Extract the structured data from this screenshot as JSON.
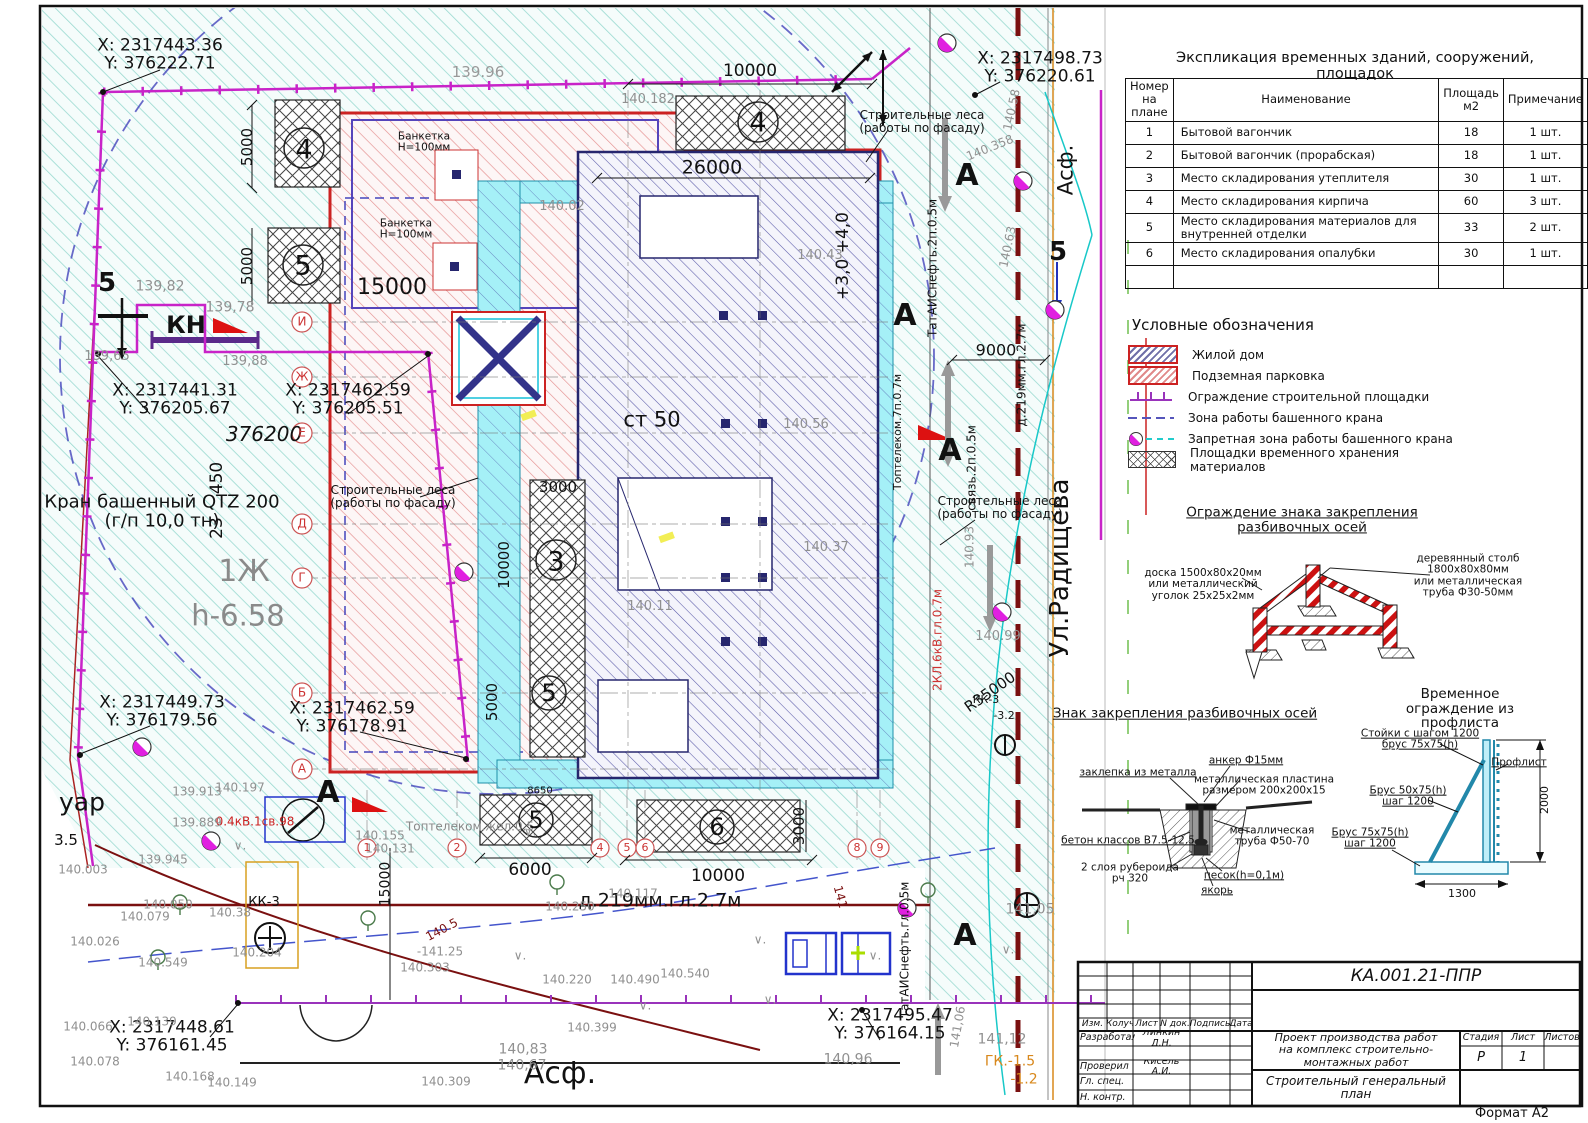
{
  "sheet": {
    "format_label": "Формат А2",
    "doc_code": "КА.001.21-ППР"
  },
  "expl_table": {
    "title": "Экспликация временных зданий, сооружений, площадок",
    "headers": [
      "Номер на плане",
      "Наименование",
      "Площадь м2",
      "Примечание"
    ],
    "rows": [
      [
        "1",
        "Бытовой вагончик",
        "18",
        "1 шт."
      ],
      [
        "2",
        "Бытовой вагончик (прорабская)",
        "18",
        "1 шт."
      ],
      [
        "3",
        "Место складирования утеплителя",
        "30",
        "1 шт."
      ],
      [
        "4",
        "Место складирования кирпича",
        "60",
        "3 шт."
      ],
      [
        "5",
        "Место складирования материалов для внутренней отделки",
        "33",
        "2 шт."
      ],
      [
        "6",
        "Место складирования опалубки",
        "30",
        "1 шт."
      ],
      [
        "",
        "",
        "",
        ""
      ]
    ]
  },
  "legend": {
    "title": "Условные обозначения",
    "items": [
      {
        "swatch": "dom",
        "label": "Жилой дом"
      },
      {
        "swatch": "park",
        "label": "Подземная парковка"
      },
      {
        "swatch": "fence",
        "label": "Ограждение строительной площадки"
      },
      {
        "swatch": "crane",
        "label": "Зона работы башенного крана"
      },
      {
        "swatch": "nozone",
        "label": "Запретная зона работы башенного крана"
      },
      {
        "swatch": "store",
        "label": "Площадки временного хранения материалов"
      }
    ]
  },
  "colors": {
    "fence": "#c823c8",
    "parking": "#cc2222",
    "building": "#26266e",
    "scaffold": "#1e8fa8",
    "no_zone": "#e020e0",
    "road_axis": "#7a1010",
    "orange_line": "#d8881c"
  },
  "titleblock": {
    "code": "КА.001.21-ППР",
    "rev_headers": {
      "izm": "Изм.",
      "koluch": "Колуч",
      "list": "Лист",
      "ndok": "N док.",
      "podpis": "Подпись",
      "data": "Дата"
    },
    "roles": {
      "developed": "Разработал",
      "checked": "Проверил",
      "chief": "Гл. спец.",
      "ncontrol": "Н. контр."
    },
    "names": {
      "developed": "Линкин Д.Н.",
      "checked": "Кисель А.И."
    },
    "project_title": "Проект производства работ\nна комплекс строительно-монтажных работ",
    "sheet_title": "Строительный генеральный план",
    "stage_header": "Стадия",
    "list_header": "Лист",
    "listov_header": "Листов",
    "stage_value": "Р",
    "list_value": "1"
  },
  "annotations": [
    {
      "t": "X: 2317443.36\nY: 376222.71",
      "x": 160,
      "y": 55,
      "s": 17
    },
    {
      "t": "X: 2317498.73\nY: 376220.61",
      "x": 1040,
      "y": 68,
      "s": 17
    },
    {
      "t": "X: 2317441.31\nY: 376205.67",
      "x": 175,
      "y": 400,
      "s": 17
    },
    {
      "t": "X: 2317462.59\nY: 376205.51",
      "x": 348,
      "y": 400,
      "s": 17
    },
    {
      "t": "X: 2317449.73\nY: 376179.56",
      "x": 162,
      "y": 712,
      "s": 17
    },
    {
      "t": "X: 2317462.59\nY: 376178.91",
      "x": 352,
      "y": 718,
      "s": 17
    },
    {
      "t": "X: 2317448.61\nY: 376161.45",
      "x": 172,
      "y": 1037,
      "s": 17
    },
    {
      "t": "X: 2317495.47\nY: 376164.15",
      "x": 890,
      "y": 1025,
      "s": 17
    },
    {
      "t": "Кран башенный QTZ 200\n(г/п 10,0 тн)",
      "x": 162,
      "y": 512,
      "s": 18
    },
    {
      "t": "КН",
      "x": 186,
      "y": 326,
      "s": 24,
      "b": 1
    },
    {
      "t": "1Ж",
      "x": 244,
      "y": 572,
      "s": 30,
      "c": "#8a8a8a"
    },
    {
      "t": "h-6.58",
      "x": 238,
      "y": 616,
      "s": 29,
      "c": "#8a8a8a"
    },
    {
      "t": "376200",
      "x": 264,
      "y": 435,
      "s": 20,
      "i": 1
    },
    {
      "t": "ст 50",
      "x": 652,
      "y": 420,
      "s": 21
    },
    {
      "t": "450",
      "x": 217,
      "y": 478,
      "s": 17,
      "r": -90
    },
    {
      "t": "23",
      "x": 217,
      "y": 528,
      "s": 17,
      "r": -90
    },
    {
      "t": "+3,0 +4,0",
      "x": 843,
      "y": 256,
      "s": 17,
      "r": -90
    },
    {
      "t": "Ул.Радищева",
      "x": 1060,
      "y": 568,
      "s": 26,
      "r": -90
    },
    {
      "t": "Асф.",
      "x": 1066,
      "y": 170,
      "s": 21,
      "r": -90
    },
    {
      "t": "Асф.",
      "x": 560,
      "y": 1074,
      "s": 30
    },
    {
      "t": "уар",
      "x": 82,
      "y": 802,
      "s": 25
    },
    {
      "t": "3.5",
      "x": 66,
      "y": 840,
      "s": 15
    },
    {
      "t": "R35000",
      "x": 990,
      "y": 692,
      "s": 15,
      "r": -35
    },
    {
      "t": "ГК.-1.5",
      "x": 1010,
      "y": 1062,
      "s": 14,
      "c": "#d8881c"
    },
    {
      "t": "-1.2",
      "x": 1024,
      "y": 1080,
      "s": 14,
      "c": "#d8881c"
    },
    {
      "t": "д.219мм.гл.2.7м",
      "x": 660,
      "y": 901,
      "s": 19
    },
    {
      "t": "д.219мм.гл.2.7м",
      "x": 1022,
      "y": 375,
      "s": 12,
      "r": -90
    },
    {
      "t": "ТатАИСнефть.2п.0.5м",
      "x": 933,
      "y": 268,
      "s": 12,
      "r": -90
    },
    {
      "t": "связь.2п.0.5м",
      "x": 972,
      "y": 468,
      "s": 12,
      "r": -90
    },
    {
      "t": "2КЛ.6кВ.гл.0.7м",
      "x": 938,
      "y": 640,
      "s": 12,
      "r": -90,
      "c": "#cc3333"
    },
    {
      "t": "Топтелеком.7п.0.7м",
      "x": 898,
      "y": 432,
      "s": 11,
      "r": -90
    },
    {
      "t": "ТатАИСнефть.гл.0.5м",
      "x": 905,
      "y": 950,
      "s": 12,
      "r": -90
    },
    {
      "t": "Топтелеком.жел.0.5",
      "x": 470,
      "y": 827,
      "s": 12,
      "c": "#888888"
    },
    {
      "t": "0.4кВ.1св.98",
      "x": 255,
      "y": 822,
      "s": 12,
      "c": "#cc2222"
    },
    {
      "t": "Строительные леса\n(работы по фасаду)",
      "x": 922,
      "y": 122,
      "s": 12
    },
    {
      "t": "Строительные леса\n(работы по фасаду)",
      "x": 393,
      "y": 497,
      "s": 12
    },
    {
      "t": "Строительные леса\n(работы по фасаду)",
      "x": 1000,
      "y": 508,
      "s": 12
    },
    {
      "t": "Банкетка\nН=100мм",
      "x": 424,
      "y": 143,
      "s": 10.5
    },
    {
      "t": "Банкетка\nН=100мм",
      "x": 406,
      "y": 230,
      "s": 10.5
    },
    {
      "t": "15000",
      "x": 392,
      "y": 288,
      "s": 22
    },
    {
      "t": "26000",
      "x": 712,
      "y": 168,
      "s": 19
    },
    {
      "t": "10000",
      "x": 750,
      "y": 71,
      "s": 17
    },
    {
      "t": "139.96",
      "x": 478,
      "y": 72,
      "s": 15,
      "c": "#999999"
    },
    {
      "t": "5000",
      "x": 247,
      "y": 147,
      "s": 15,
      "r": -90
    },
    {
      "t": "5000",
      "x": 247,
      "y": 266,
      "s": 15,
      "r": -90
    },
    {
      "t": "3000",
      "x": 558,
      "y": 487,
      "s": 15
    },
    {
      "t": "10000",
      "x": 504,
      "y": 565,
      "s": 15,
      "r": -90
    },
    {
      "t": "5000",
      "x": 492,
      "y": 702,
      "s": 15,
      "r": -90
    },
    {
      "t": "6000",
      "x": 530,
      "y": 870,
      "s": 17
    },
    {
      "t": "10000",
      "x": 718,
      "y": 876,
      "s": 17
    },
    {
      "t": "3000",
      "x": 799,
      "y": 826,
      "s": 15,
      "r": -90
    },
    {
      "t": "9000",
      "x": 996,
      "y": 350,
      "s": 16
    },
    {
      "t": "15000",
      "x": 386,
      "y": 884,
      "s": 14,
      "r": -90
    },
    {
      "t": "8650",
      "x": 540,
      "y": 792,
      "s": 10
    },
    {
      "t": "139,82",
      "x": 160,
      "y": 287,
      "s": 14,
      "c": "#909090"
    },
    {
      "t": "139,78",
      "x": 230,
      "y": 308,
      "s": 14,
      "c": "#909090"
    },
    {
      "t": "139,65",
      "x": 107,
      "y": 357,
      "s": 13,
      "c": "#909090"
    },
    {
      "t": "139,88",
      "x": 245,
      "y": 362,
      "s": 13,
      "c": "#909090"
    },
    {
      "t": "140.182",
      "x": 648,
      "y": 100,
      "s": 13,
      "c": "#909090"
    },
    {
      "t": "140.02",
      "x": 562,
      "y": 207,
      "s": 13,
      "c": "#909090"
    },
    {
      "t": "140.43",
      "x": 820,
      "y": 256,
      "s": 13,
      "c": "#909090"
    },
    {
      "t": "140.56",
      "x": 806,
      "y": 425,
      "s": 13,
      "c": "#909090"
    },
    {
      "t": "140.11",
      "x": 650,
      "y": 607,
      "s": 13,
      "c": "#909090"
    },
    {
      "t": "140.37",
      "x": 826,
      "y": 548,
      "s": 13,
      "c": "#909090"
    },
    {
      "t": "140.58",
      "x": 1012,
      "y": 110,
      "s": 12,
      "c": "#909090",
      "r": -78
    },
    {
      "t": "140.358",
      "x": 990,
      "y": 148,
      "s": 12,
      "c": "#909090",
      "r": -22
    },
    {
      "t": "140.63",
      "x": 1008,
      "y": 247,
      "s": 12,
      "c": "#909090",
      "r": -78
    },
    {
      "t": "140.99",
      "x": 998,
      "y": 637,
      "s": 13,
      "c": "#909090"
    },
    {
      "t": "140.93",
      "x": 970,
      "y": 547,
      "s": 12,
      "c": "#909090",
      "r": -90
    },
    {
      "t": "141,05",
      "x": 1030,
      "y": 910,
      "s": 14,
      "c": "#909090"
    },
    {
      "t": "141,12",
      "x": 1002,
      "y": 1040,
      "s": 14,
      "c": "#909090"
    },
    {
      "t": "141,06",
      "x": 958,
      "y": 1027,
      "s": 12,
      "c": "#909090",
      "r": -80
    },
    {
      "t": "140,96",
      "x": 848,
      "y": 1060,
      "s": 14,
      "c": "#909090"
    },
    {
      "t": "139.913",
      "x": 197,
      "y": 792,
      "s": 12,
      "c": "#909090"
    },
    {
      "t": "140.197",
      "x": 240,
      "y": 788,
      "s": 12,
      "c": "#909090"
    },
    {
      "t": "139.889",
      "x": 197,
      "y": 823,
      "s": 12,
      "c": "#909090"
    },
    {
      "t": "139.945",
      "x": 163,
      "y": 860,
      "s": 12,
      "c": "#909090"
    },
    {
      "t": "140.003",
      "x": 83,
      "y": 870,
      "s": 12,
      "c": "#909090"
    },
    {
      "t": "140.050",
      "x": 168,
      "y": 905,
      "s": 12,
      "c": "#909090"
    },
    {
      "t": "140.079",
      "x": 145,
      "y": 917,
      "s": 12,
      "c": "#909090"
    },
    {
      "t": "140.026",
      "x": 95,
      "y": 942,
      "s": 12,
      "c": "#909090"
    },
    {
      "t": "140.549",
      "x": 163,
      "y": 963,
      "s": 12,
      "c": "#909090"
    },
    {
      "t": "140.38",
      "x": 230,
      "y": 913,
      "s": 12,
      "c": "#909090"
    },
    {
      "t": "140.204",
      "x": 257,
      "y": 953,
      "s": 12,
      "c": "#909090"
    },
    {
      "t": "140.131",
      "x": 390,
      "y": 849,
      "s": 12,
      "c": "#909090"
    },
    {
      "t": "140.155",
      "x": 380,
      "y": 836,
      "s": 12,
      "c": "#909090"
    },
    {
      "t": "140.250",
      "x": 570,
      "y": 907,
      "s": 12,
      "c": "#909090"
    },
    {
      "t": "140.117",
      "x": 633,
      "y": 894,
      "s": 12,
      "c": "#909090"
    },
    {
      "t": "140.220",
      "x": 567,
      "y": 980,
      "s": 12,
      "c": "#909090"
    },
    {
      "t": "140.490",
      "x": 635,
      "y": 980,
      "s": 12,
      "c": "#909090"
    },
    {
      "t": "140.540",
      "x": 685,
      "y": 974,
      "s": 12,
      "c": "#909090"
    },
    {
      "t": "140.399",
      "x": 592,
      "y": 1028,
      "s": 12,
      "c": "#909090"
    },
    {
      "t": "140,83",
      "x": 523,
      "y": 1050,
      "s": 14,
      "c": "#909090"
    },
    {
      "t": "140,67",
      "x": 522,
      "y": 1066,
      "s": 14,
      "c": "#909090"
    },
    {
      "t": "140.309",
      "x": 446,
      "y": 1082,
      "s": 12,
      "c": "#909090"
    },
    {
      "t": "-141.25",
      "x": 440,
      "y": 952,
      "s": 12,
      "c": "#909090"
    },
    {
      "t": "140.303",
      "x": 425,
      "y": 968,
      "s": 12,
      "c": "#909090"
    },
    {
      "t": "140.066",
      "x": 88,
      "y": 1027,
      "s": 12,
      "c": "#909090"
    },
    {
      "t": "140.078",
      "x": 95,
      "y": 1062,
      "s": 12,
      "c": "#909090"
    },
    {
      "t": "140.139",
      "x": 152,
      "y": 1022,
      "s": 12,
      "c": "#909090"
    },
    {
      "t": "140.168",
      "x": 190,
      "y": 1077,
      "s": 12,
      "c": "#909090"
    },
    {
      "t": "140.149",
      "x": 232,
      "y": 1083,
      "s": 12,
      "c": "#909090"
    },
    {
      "t": "141",
      "x": 840,
      "y": 897,
      "s": 12,
      "c": "#7a1010",
      "r": 75
    },
    {
      "t": "140.5",
      "x": 442,
      "y": 930,
      "s": 12,
      "c": "#7a1010",
      "r": -28
    },
    {
      "t": "И",
      "x": 302,
      "y": 322,
      "s": 12,
      "c": "#cc3333"
    },
    {
      "t": "Ж",
      "x": 302,
      "y": 377,
      "s": 12,
      "c": "#cc3333"
    },
    {
      "t": "Е",
      "x": 302,
      "y": 433,
      "s": 12,
      "c": "#cc3333"
    },
    {
      "t": "Д",
      "x": 302,
      "y": 524,
      "s": 12,
      "c": "#cc3333"
    },
    {
      "t": "Г",
      "x": 302,
      "y": 578,
      "s": 12,
      "c": "#cc3333"
    },
    {
      "t": "Б",
      "x": 302,
      "y": 693,
      "s": 12,
      "c": "#cc3333"
    },
    {
      "t": "А",
      "x": 302,
      "y": 769,
      "s": 12,
      "c": "#cc3333"
    },
    {
      "t": "1",
      "x": 367,
      "y": 848,
      "s": 11,
      "c": "#cc3333"
    },
    {
      "t": "2",
      "x": 457,
      "y": 848,
      "s": 11,
      "c": "#cc3333"
    },
    {
      "t": "4",
      "x": 600,
      "y": 848,
      "s": 11,
      "c": "#cc3333"
    },
    {
      "t": "5",
      "x": 627,
      "y": 848,
      "s": 11,
      "c": "#cc3333"
    },
    {
      "t": "6",
      "x": 645,
      "y": 848,
      "s": 11,
      "c": "#cc3333"
    },
    {
      "t": "8",
      "x": 857,
      "y": 848,
      "s": 11,
      "c": "#cc3333"
    },
    {
      "t": "9",
      "x": 880,
      "y": 848,
      "s": 11,
      "c": "#cc3333"
    },
    {
      "t": "4",
      "x": 304,
      "y": 150,
      "s": 27
    },
    {
      "t": "5",
      "x": 303,
      "y": 266,
      "s": 27
    },
    {
      "t": "4",
      "x": 758,
      "y": 123,
      "s": 27
    },
    {
      "t": "3",
      "x": 556,
      "y": 562,
      "s": 27
    },
    {
      "t": "5",
      "x": 549,
      "y": 694,
      "s": 24
    },
    {
      "t": "5",
      "x": 536,
      "y": 821,
      "s": 24
    },
    {
      "t": "6",
      "x": 717,
      "y": 828,
      "s": 24
    },
    {
      "t": "А",
      "x": 967,
      "y": 176,
      "s": 30,
      "b": 1
    },
    {
      "t": "А",
      "x": 905,
      "y": 316,
      "s": 30,
      "b": 1
    },
    {
      "t": "А",
      "x": 950,
      "y": 451,
      "s": 30,
      "b": 1
    },
    {
      "t": "А",
      "x": 328,
      "y": 793,
      "s": 30,
      "b": 1
    },
    {
      "t": "А",
      "x": 965,
      "y": 936,
      "s": 30,
      "b": 1
    },
    {
      "t": "5",
      "x": 107,
      "y": 283,
      "s": 26,
      "b": 1
    },
    {
      "t": "5",
      "x": 1058,
      "y": 252,
      "s": 26,
      "b": 1
    },
    {
      "t": "КК-3",
      "x": 264,
      "y": 903,
      "s": 13
    },
    {
      "t": "КК-3",
      "x": 986,
      "y": 700,
      "s": 11
    },
    {
      "t": "-3.2",
      "x": 1004,
      "y": 716,
      "s": 11
    },
    {
      "t": "∨.",
      "x": 240,
      "y": 846,
      "s": 12,
      "c": "#909090"
    },
    {
      "t": "∨.",
      "x": 520,
      "y": 956,
      "s": 12,
      "c": "#909090"
    },
    {
      "t": "∨.",
      "x": 760,
      "y": 940,
      "s": 12,
      "c": "#909090"
    },
    {
      "t": "∨.",
      "x": 875,
      "y": 956,
      "s": 12,
      "c": "#909090"
    },
    {
      "t": "∨.",
      "x": 1008,
      "y": 950,
      "s": 12,
      "c": "#909090"
    },
    {
      "t": "∨.",
      "x": 645,
      "y": 1006,
      "s": 12,
      "c": "#909090"
    },
    {
      "t": "∨.",
      "x": 770,
      "y": 1000,
      "s": 12,
      "c": "#909090"
    },
    {
      "t": "∨.",
      "x": 530,
      "y": 832,
      "s": 12,
      "c": "#909090"
    },
    {
      "t": "Ограждение знака закрепления разбивочных осей",
      "x": 1302,
      "y": 520,
      "s": 13.5,
      "u": 1
    },
    {
      "t": "доска 1500х80х20мм\nили металлический\nуголок 25х25х2мм",
      "x": 1203,
      "y": 585,
      "s": 10.5
    },
    {
      "t": "деревянный столб 1800х80х80мм\nили металлическая труба Ф30-50мм",
      "x": 1468,
      "y": 576,
      "s": 10.5
    },
    {
      "t": "Знак закрепления разбивочных осей",
      "x": 1185,
      "y": 714,
      "s": 13.5,
      "u": 1
    },
    {
      "t": "заклепка из металла",
      "x": 1138,
      "y": 773,
      "s": 10.5,
      "u": 1
    },
    {
      "t": "анкер Ф15мм",
      "x": 1246,
      "y": 761,
      "s": 10.5,
      "u": 1
    },
    {
      "t": "металлическая пластина\nразмером 200х200х15",
      "x": 1264,
      "y": 786,
      "s": 10.5
    },
    {
      "t": "металлическая\nтруба Ф50-70",
      "x": 1272,
      "y": 837,
      "s": 10.5
    },
    {
      "t": "бетон классов В7.5-12.5",
      "x": 1128,
      "y": 841,
      "s": 10.5,
      "u": 1
    },
    {
      "t": "2 слоя рубероида\nрч 320",
      "x": 1130,
      "y": 874,
      "s": 10.5
    },
    {
      "t": "песок(h=0,1м)",
      "x": 1244,
      "y": 876,
      "s": 10.5,
      "u": 1
    },
    {
      "t": "якорь",
      "x": 1217,
      "y": 891,
      "s": 10.5,
      "u": 1
    },
    {
      "t": "Временное ограждение из профлиста",
      "x": 1460,
      "y": 709,
      "s": 13.5
    },
    {
      "t": "Стойки с шагом 1200\nбрус 75х75(h)",
      "x": 1420,
      "y": 740,
      "s": 10.5,
      "u": 1
    },
    {
      "t": "Профлист",
      "x": 1519,
      "y": 763,
      "s": 10.5,
      "u": 1
    },
    {
      "t": "Брус 50х75(h)\nшаг 1200",
      "x": 1408,
      "y": 797,
      "s": 10.5,
      "u": 1
    },
    {
      "t": "Брус 75х75(h)\nшаг 1200",
      "x": 1370,
      "y": 839,
      "s": 10.5,
      "u": 1
    },
    {
      "t": "2000",
      "x": 1545,
      "y": 800,
      "s": 11,
      "r": -90
    },
    {
      "t": "1300",
      "x": 1462,
      "y": 894,
      "s": 11
    },
    {
      "t": "Формат А2",
      "x": 1512,
      "y": 1114,
      "s": 13
    }
  ]
}
